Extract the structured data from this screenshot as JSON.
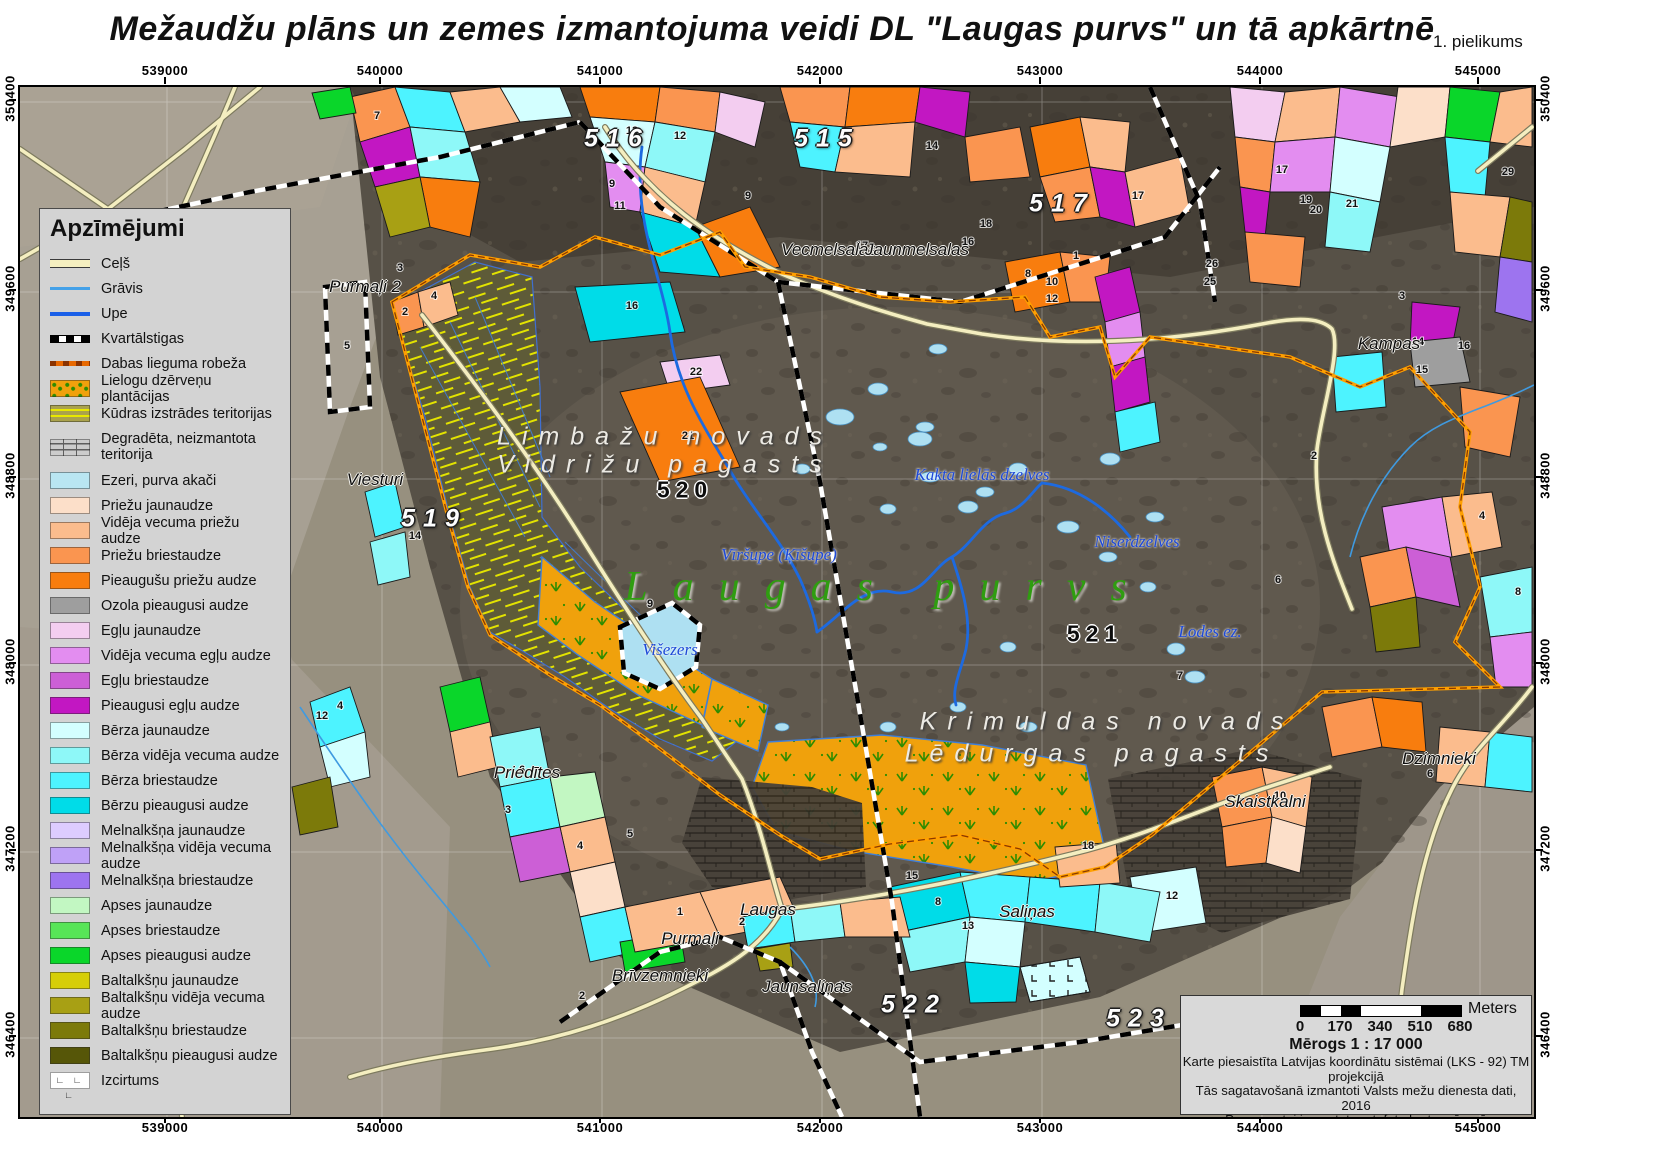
{
  "title": "Mežaudžu plāns un zemes izmantojuma veidi DL \"Laugas purvs\" un tā apkārtnē",
  "annex": "1. pielikums",
  "axes": {
    "x_labels": [
      "539000",
      "540000",
      "541000",
      "542000",
      "543000",
      "544000",
      "545000"
    ],
    "y_labels": [
      "350400",
      "349600",
      "348800",
      "348000",
      "347200",
      "346400"
    ]
  },
  "legend": {
    "title": "Apzīmējumi",
    "line_items": [
      {
        "label": "Ceļš",
        "type": "road",
        "color": "#f5efc0"
      },
      {
        "label": "Grāvis",
        "type": "ditch",
        "color": "#44a1e8"
      },
      {
        "label": "Upe",
        "type": "river",
        "color": "#1a5fe8"
      },
      {
        "label": "Kvartālstigas",
        "type": "dash",
        "color": "#000000"
      },
      {
        "label": "Dabas lieguma robeža",
        "type": "bound",
        "color": "#e86800"
      }
    ],
    "area_items": [
      {
        "label": "Lielogu dzērveņu plantācijas",
        "type": "cran",
        "color": "#f0a10c"
      },
      {
        "label": "Kūdras izstrādes teritorijas",
        "type": "peat",
        "color": "#aaa24c"
      },
      {
        "label": "Degradēta, neizmantota teritorija",
        "type": "degr",
        "color": "#cccccc",
        "tall": true
      },
      {
        "label": "Ezeri, purva akači",
        "color": "#b9e6f2"
      },
      {
        "label": "Priežu jaunaudze",
        "color": "#fcdfc9"
      },
      {
        "label": "Vidēja vecuma priežu audze",
        "color": "#fbbc8d"
      },
      {
        "label": "Priežu briestaudze",
        "color": "#fa9550"
      },
      {
        "label": "Pieaugušu priežu audze",
        "color": "#f87d0e"
      },
      {
        "label": "Ozola pieaugusi audze",
        "color": "#9e9e9e"
      },
      {
        "label": "Egļu jaunaudze",
        "color": "#f3cdf0"
      },
      {
        "label": "Vidēja vecuma egļu audze",
        "color": "#e38df0"
      },
      {
        "label": "Egļu briestaudze",
        "color": "#cc5fd6"
      },
      {
        "label": "Pieaugusi egļu audze",
        "color": "#c217c2"
      },
      {
        "label": "Bērza jaunaudze",
        "color": "#d3ffff"
      },
      {
        "label": "Bērza vidēja vecuma audze",
        "color": "#8ef8f8"
      },
      {
        "label": "Bērza briestaudze",
        "color": "#4df3ff"
      },
      {
        "label": "Bērzu pieaugusi audze",
        "color": "#00dce8"
      },
      {
        "label": "Melnalkšņa jaunaudze",
        "color": "#ddccff"
      },
      {
        "label": "Melnalkšņa vidēja vecuma audze",
        "color": "#bfa1f7"
      },
      {
        "label": "Melnalkšņa briestaudze",
        "color": "#9d74ef"
      },
      {
        "label": "Apses jaunaudze",
        "color": "#c2f7c2"
      },
      {
        "label": "Apses briestaudze",
        "color": "#57e557"
      },
      {
        "label": "Apses pieaugusi audze",
        "color": "#0ad62a"
      },
      {
        "label": "Baltalkšņu jaunaudze",
        "color": "#d6ce08"
      },
      {
        "label": "Baltalkšņu vidēja vecuma audze",
        "color": "#a8a014"
      },
      {
        "label": "Baltalkšņu briestaudze",
        "color": "#7c7a0a"
      },
      {
        "label": "Baltalkšņu pieaugusi audze",
        "color": "#565608"
      },
      {
        "label": "Izcirtums",
        "type": "izc",
        "color": "#ffffff"
      }
    ]
  },
  "map_labels": {
    "quartals": [
      {
        "text": "516",
        "x": 597,
        "y": 52,
        "style": "white"
      },
      {
        "text": "515",
        "x": 807,
        "y": 52,
        "style": "white"
      },
      {
        "text": "517",
        "x": 1042,
        "y": 117,
        "style": "white"
      },
      {
        "text": "519",
        "x": 414,
        "y": 432,
        "style": "white"
      },
      {
        "text": "520",
        "x": 665,
        "y": 403,
        "style": "black"
      },
      {
        "text": "521",
        "x": 1075,
        "y": 547,
        "style": "black"
      },
      {
        "text": "522",
        "x": 894,
        "y": 918,
        "style": "white"
      },
      {
        "text": "523",
        "x": 1119,
        "y": 932,
        "style": "white"
      }
    ],
    "places": [
      {
        "text": "Vecmelsalas",
        "x": 809,
        "y": 163
      },
      {
        "text": "Jaunmelsalas",
        "x": 897,
        "y": 163
      },
      {
        "text": "Purmaļi 2",
        "x": 345,
        "y": 200
      },
      {
        "text": "Kampas",
        "x": 1369,
        "y": 257
      },
      {
        "text": "Viesturi",
        "x": 355,
        "y": 393
      },
      {
        "text": "Priedītes",
        "x": 507,
        "y": 686
      },
      {
        "text": "Laugas",
        "x": 748,
        "y": 823
      },
      {
        "text": "Purmaļi",
        "x": 670,
        "y": 852
      },
      {
        "text": "Brīvzemnieki",
        "x": 640,
        "y": 889
      },
      {
        "text": "Jaunsaliņas",
        "x": 787,
        "y": 900
      },
      {
        "text": "Saliņas",
        "x": 1007,
        "y": 825
      },
      {
        "text": "Skaistkalni",
        "x": 1245,
        "y": 715
      },
      {
        "text": "Dzimnieki",
        "x": 1419,
        "y": 672
      }
    ],
    "regions": [
      {
        "text": "Limbažu novads",
        "x": 645,
        "y": 350
      },
      {
        "text": "Vidrižu pagasts",
        "x": 645,
        "y": 378
      },
      {
        "text": "Krimuldas novads",
        "x": 1087,
        "y": 635
      },
      {
        "text": "Lēdurgas pagasts",
        "x": 1072,
        "y": 667
      }
    ],
    "waters": [
      {
        "text": "Kakta lielās dzelves",
        "x": 962,
        "y": 388
      },
      {
        "text": "Niserdzelves",
        "x": 1117,
        "y": 455
      },
      {
        "text": "Vīršupe (Ķīšupe)",
        "x": 759,
        "y": 468
      },
      {
        "text": "Lodes ez.",
        "x": 1190,
        "y": 545
      },
      {
        "text": "Višezers",
        "x": 650,
        "y": 563
      }
    ],
    "bog": {
      "text": "Laugas purvs",
      "x": 868,
      "y": 500
    }
  },
  "stand_numbers": [
    {
      "n": "7",
      "x": 357,
      "y": 32
    },
    {
      "n": "13",
      "x": 612,
      "y": 47
    },
    {
      "n": "12",
      "x": 660,
      "y": 52
    },
    {
      "n": "9",
      "x": 592,
      "y": 100
    },
    {
      "n": "11",
      "x": 600,
      "y": 122
    },
    {
      "n": "16",
      "x": 612,
      "y": 222
    },
    {
      "n": "22",
      "x": 676,
      "y": 288
    },
    {
      "n": "21",
      "x": 668,
      "y": 352
    },
    {
      "n": "14",
      "x": 912,
      "y": 62
    },
    {
      "n": "16",
      "x": 948,
      "y": 158
    },
    {
      "n": "17",
      "x": 842,
      "y": 162
    },
    {
      "n": "9",
      "x": 728,
      "y": 112
    },
    {
      "n": "1",
      "x": 1056,
      "y": 172
    },
    {
      "n": "8",
      "x": 1008,
      "y": 190
    },
    {
      "n": "10",
      "x": 1032,
      "y": 198
    },
    {
      "n": "12",
      "x": 1032,
      "y": 215
    },
    {
      "n": "17",
      "x": 1118,
      "y": 112
    },
    {
      "n": "18",
      "x": 966,
      "y": 140
    },
    {
      "n": "26",
      "x": 1192,
      "y": 180
    },
    {
      "n": "25",
      "x": 1190,
      "y": 198
    },
    {
      "n": "20",
      "x": 1296,
      "y": 126
    },
    {
      "n": "21",
      "x": 1332,
      "y": 120
    },
    {
      "n": "19",
      "x": 1286,
      "y": 116
    },
    {
      "n": "29",
      "x": 1488,
      "y": 88
    },
    {
      "n": "17",
      "x": 1262,
      "y": 86
    },
    {
      "n": "3",
      "x": 1382,
      "y": 212
    },
    {
      "n": "14",
      "x": 1398,
      "y": 258
    },
    {
      "n": "15",
      "x": 1402,
      "y": 286
    },
    {
      "n": "16",
      "x": 1444,
      "y": 262
    },
    {
      "n": "2",
      "x": 1294,
      "y": 372
    },
    {
      "n": "4",
      "x": 1462,
      "y": 432
    },
    {
      "n": "8",
      "x": 1498,
      "y": 508
    },
    {
      "n": "6",
      "x": 1258,
      "y": 496
    },
    {
      "n": "5",
      "x": 327,
      "y": 262
    },
    {
      "n": "2",
      "x": 385,
      "y": 228
    },
    {
      "n": "4",
      "x": 414,
      "y": 212
    },
    {
      "n": "3",
      "x": 380,
      "y": 184
    },
    {
      "n": "9",
      "x": 630,
      "y": 520
    },
    {
      "n": "12",
      "x": 302,
      "y": 632
    },
    {
      "n": "4",
      "x": 320,
      "y": 622
    },
    {
      "n": "6",
      "x": 502,
      "y": 686
    },
    {
      "n": "3",
      "x": 488,
      "y": 726
    },
    {
      "n": "5",
      "x": 610,
      "y": 750
    },
    {
      "n": "4",
      "x": 560,
      "y": 762
    },
    {
      "n": "1",
      "x": 660,
      "y": 828
    },
    {
      "n": "2",
      "x": 722,
      "y": 838
    },
    {
      "n": "8",
      "x": 918,
      "y": 818
    },
    {
      "n": "15",
      "x": 892,
      "y": 792
    },
    {
      "n": "13",
      "x": 948,
      "y": 842
    },
    {
      "n": "18",
      "x": 1068,
      "y": 762
    },
    {
      "n": "12",
      "x": 1152,
      "y": 812
    },
    {
      "n": "2",
      "x": 822,
      "y": 902
    },
    {
      "n": "2",
      "x": 562,
      "y": 912
    },
    {
      "n": "7",
      "x": 1160,
      "y": 592
    },
    {
      "n": "10",
      "x": 1260,
      "y": 712
    },
    {
      "n": "6",
      "x": 1410,
      "y": 690
    },
    {
      "n": "14",
      "x": 395,
      "y": 452
    }
  ],
  "scale_box": {
    "meters_label": "Meters",
    "ticks": [
      "0",
      "170",
      "340",
      "510",
      "680"
    ],
    "scale_text": "Mērogs 1 : 17 000",
    "credits": [
      "Karte piesaistīta Latvijas koordinātu sistēmai (LKS - 92) TM projekcijā",
      "Tās sagatavošanā izmantoti Valsts mežu dienesta dati, 2016",
      "Par pamatni izmantota ortofoto karte mērogā",
      "1: 10 000 ©Latvijas Ģeotelpiskās informācijas aģentūra, 2009"
    ]
  }
}
